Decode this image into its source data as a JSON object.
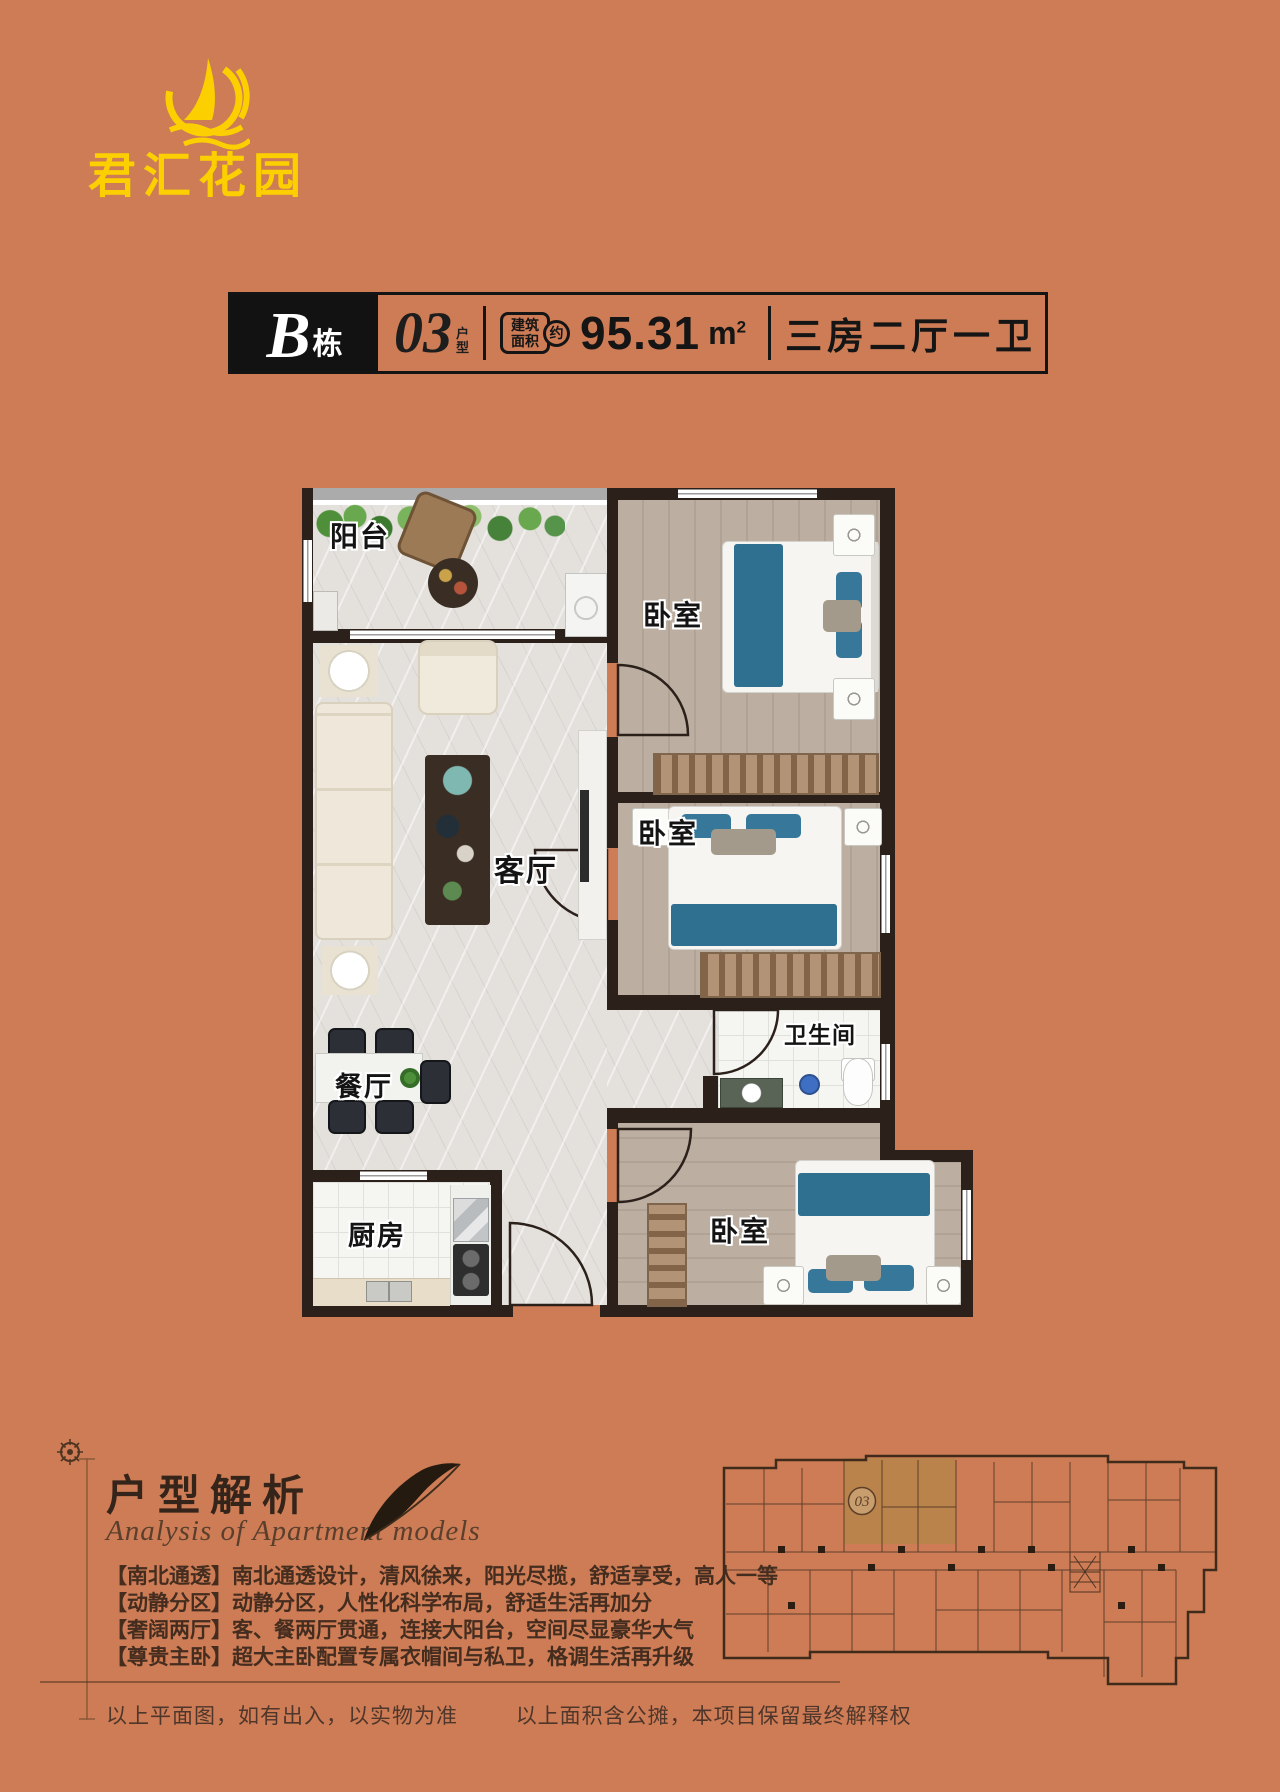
{
  "logo": {
    "name": "君汇花园"
  },
  "title_bar": {
    "building_letter": "B",
    "building_unit": "栋",
    "unit_number": "03",
    "unit_type_char1": "户",
    "unit_type_char2": "型",
    "area_badge_line1": "建筑",
    "area_badge_line2": "面积",
    "area_badge_circle": "约",
    "area_value": "95.31",
    "area_unit": "m",
    "area_sup": "2",
    "layout_summary": "三房二厅一卫"
  },
  "floor_plan": {
    "labels": {
      "balcony": "阳台",
      "bedroom_top": "卧室",
      "bedroom_middle": "卧室",
      "bedroom_bottom": "卧室",
      "living": "客厅",
      "dining": "餐厅",
      "bathroom": "卫生间",
      "kitchen": "厨房"
    }
  },
  "analysis": {
    "title": "户型解析",
    "subtitle": "Analysis of Apartment models",
    "bullets": [
      "【南北通透】南北通透设计，清风徐来，阳光尽揽，舒适享受，高人一等",
      "【动静分区】动静分区，人性化科学布局，舒适生活再加分",
      "【奢阔两厅】客、餐两厅贯通，连接大阳台，空间尽显豪华大气",
      "【尊贵主卧】超大主卧配置专属衣帽间与私卫，格调生活再升级"
    ]
  },
  "mini_plan": {
    "unit_label": "03"
  },
  "footer": {
    "disclaimer_left": "以上平面图，如有出入，以实物为准",
    "disclaimer_right": "以上面积含公摊，本项目保留最终解释权"
  }
}
